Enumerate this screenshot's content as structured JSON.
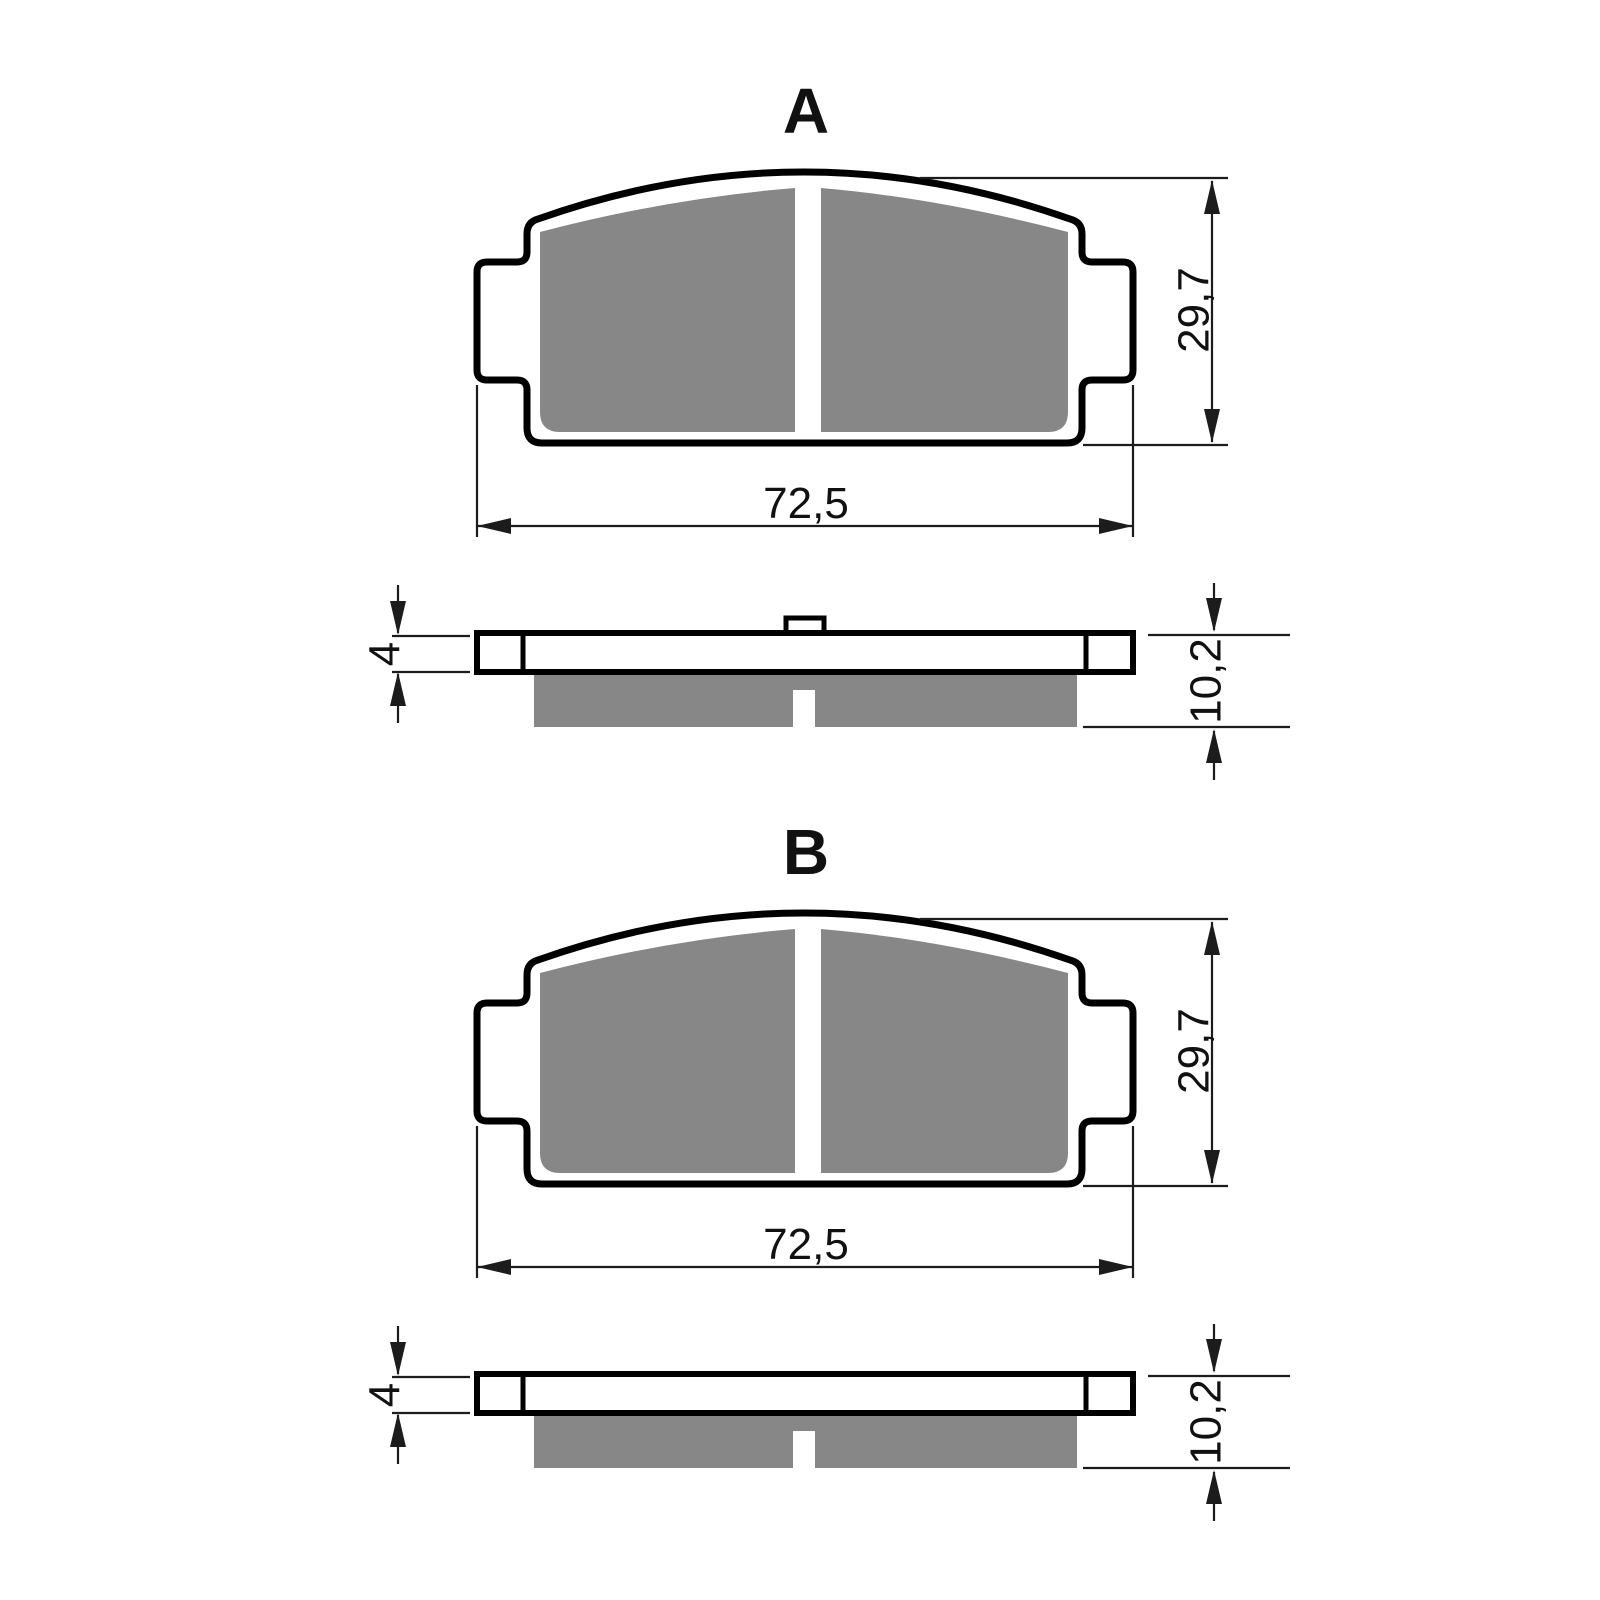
{
  "drawing": {
    "title_letters": [
      "A",
      "B"
    ],
    "sections": [
      {
        "label": "A",
        "view_front": {
          "width_dimension": "72,5",
          "height_dimension": "29,7"
        },
        "view_side": {
          "backing_plate_thickness": "4",
          "overall_thickness": "10,2",
          "has_top_tab": true
        }
      },
      {
        "label": "B",
        "view_front": {
          "width_dimension": "72,5",
          "height_dimension": "29,7"
        },
        "view_side": {
          "backing_plate_thickness": "4",
          "overall_thickness": "10,2",
          "has_top_tab": false
        }
      }
    ],
    "colors": {
      "friction_material": "#878787",
      "outline": "#000000",
      "dimension_lines": "#1c1c1c",
      "background": "#ffffff"
    }
  }
}
